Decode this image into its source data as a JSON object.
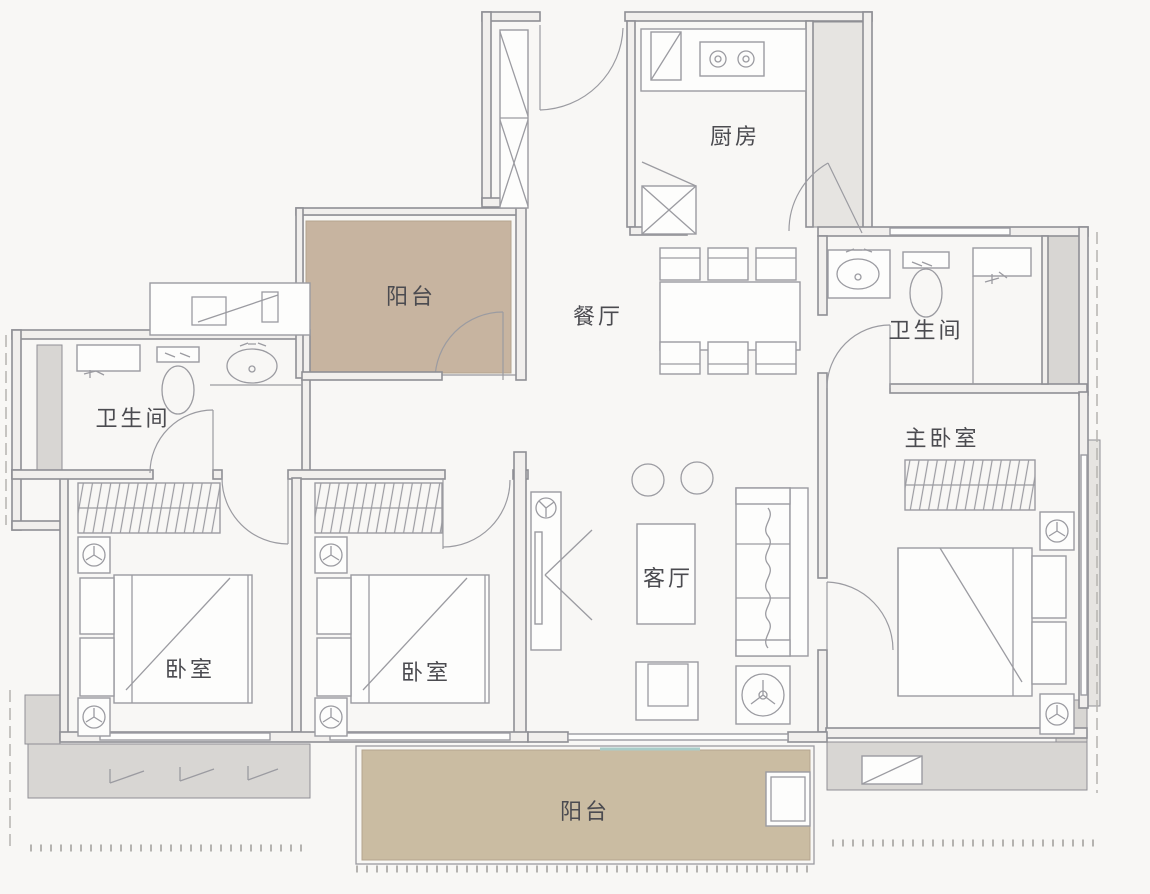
{
  "floorplan": {
    "rooms": {
      "kitchen": {
        "label": "厨房"
      },
      "balcony_top": {
        "label": "阳台"
      },
      "dining": {
        "label": "餐厅"
      },
      "bath_right": {
        "label": "卫生间"
      },
      "bath_left": {
        "label": "卫生间"
      },
      "master_bedroom": {
        "label": "主卧室"
      },
      "living": {
        "label": "客厅"
      },
      "bedroom_left": {
        "label": "卧室"
      },
      "bedroom_mid": {
        "label": "卧室"
      },
      "balcony_bottom": {
        "label": "阳台"
      }
    },
    "colors": {
      "background": "#f8f7f5",
      "wall_line": "#8f8f95",
      "furniture_line": "#9b9ba1",
      "wall_fill": "#f1efed",
      "gray_fill": "#d8d6d3",
      "gray_fill_light": "#e6e4e1",
      "balcony_fill_top": "#c7b4a0",
      "balcony_fill_bottom": "#cabca2",
      "label_text": "#4b4b50",
      "sliding_door_accent": "#a9cdc9"
    }
  }
}
